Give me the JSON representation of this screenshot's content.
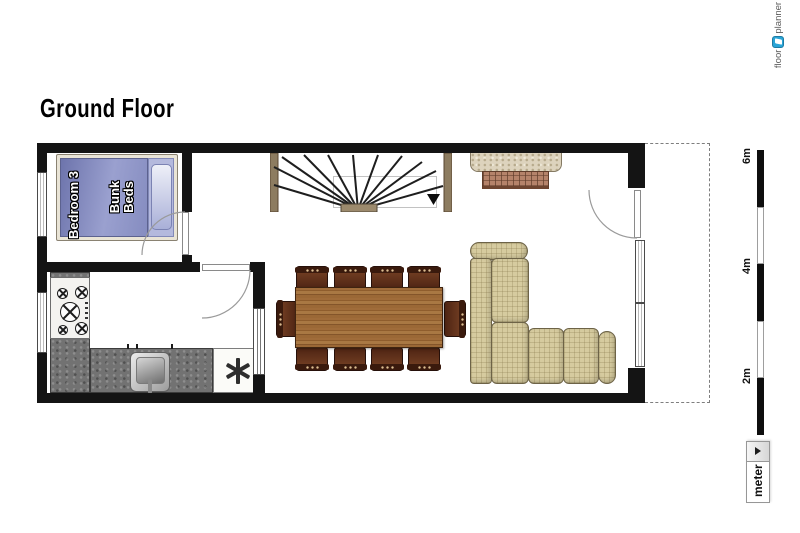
{
  "header": {
    "title": "Ground Floor"
  },
  "brand": {
    "word1": "floor",
    "word2": "planner",
    "icon_color": "#2aa4d6"
  },
  "plan": {
    "bedroom_label": "Bedroom 3",
    "bed_label": {
      "line1": "Bunk",
      "line2": "Beds"
    },
    "objects": [
      "bunk-bed",
      "stairs",
      "fireplace",
      "dining-table",
      "dining-chairs",
      "corner-sofa",
      "kitchen-counter",
      "stove",
      "sink",
      "dishwasher",
      "doors",
      "windows",
      "terrace"
    ],
    "colors": {
      "wall": "#141414",
      "bed": "#8a90c2",
      "table": "#996535",
      "chair": "#5c2e1b",
      "sofa": "#d6cb9f",
      "counter": "#727272",
      "fireplace_mantel": "#ddd3bd",
      "fireplace_brick": "#b5836a"
    }
  },
  "scale_bar": {
    "ticks": [
      {
        "label": "6m"
      },
      {
        "label": "4m"
      },
      {
        "label": "2m"
      }
    ],
    "unit_selector": {
      "value": "meter"
    }
  }
}
